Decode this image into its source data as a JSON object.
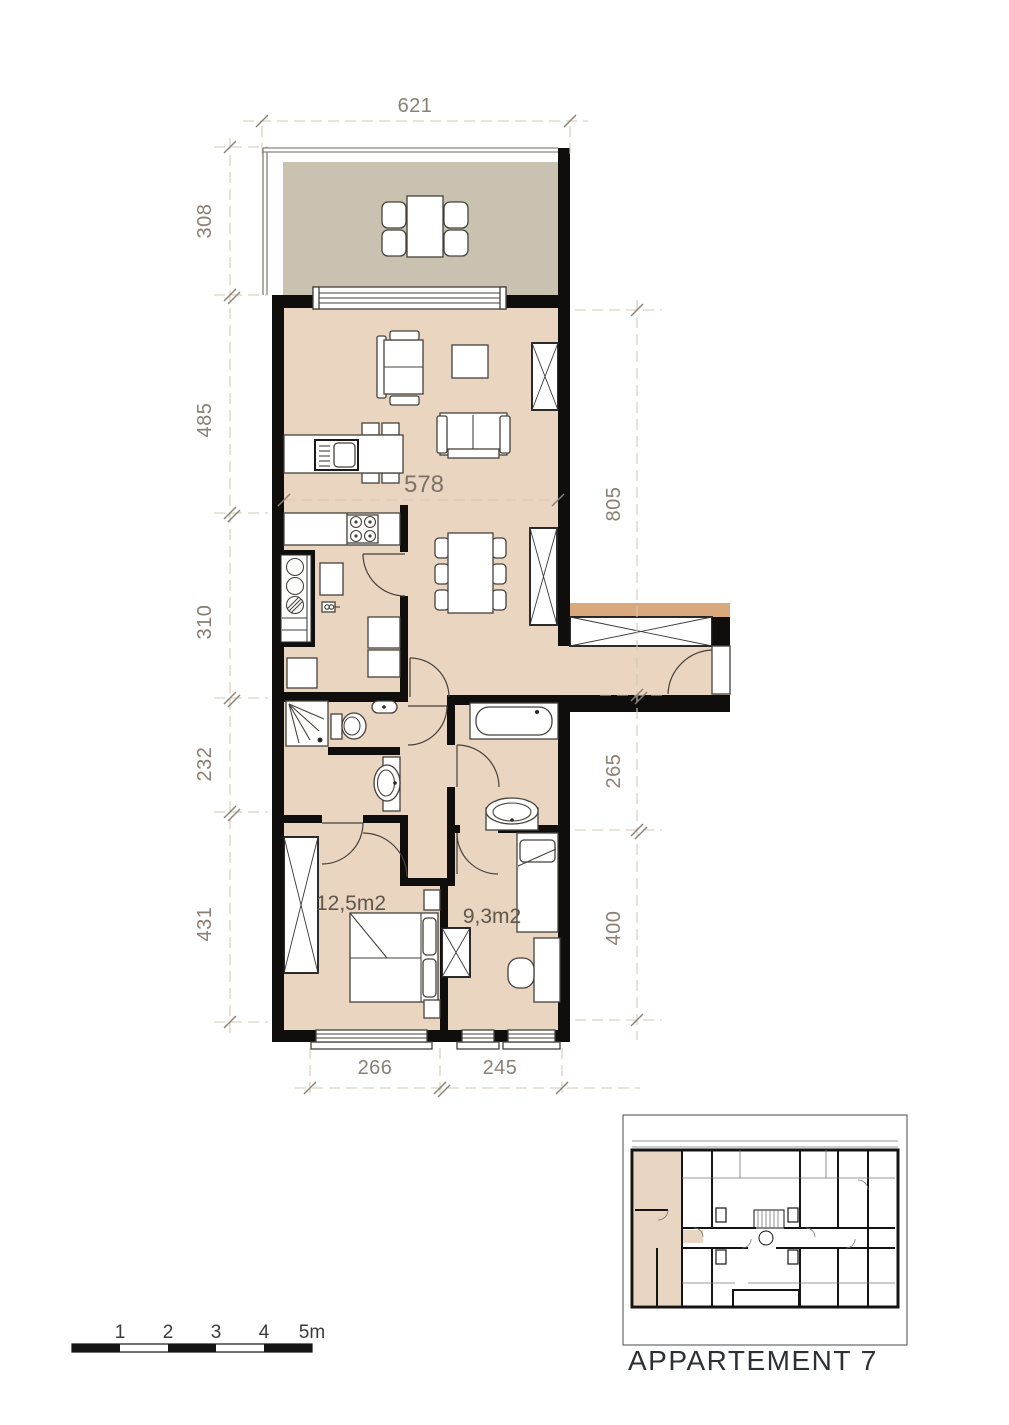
{
  "colors": {
    "wall": "#0f0e0c",
    "room": "#e9d5c0",
    "terrace": "#c9c2b1",
    "tan": "#d9a87c",
    "overview_room": "#e8d6c3",
    "dash": "#d2c8ba",
    "tick": "#8b8176",
    "dim_text": "#8a7f73",
    "ink": "#45413b"
  },
  "floor_plan": {
    "dimensions": {
      "top": "621",
      "left": [
        "308",
        "485",
        "310",
        "232",
        "431"
      ],
      "right": [
        "805",
        "265",
        "400"
      ],
      "bottom": [
        "266",
        "245"
      ],
      "interior_width": "578"
    },
    "rooms": {
      "bedroom_1": "12,5m2",
      "bedroom_2": "9,3m2"
    }
  },
  "scale_bar": {
    "labels": [
      "1",
      "2",
      "3",
      "4",
      "5m"
    ]
  },
  "overview": {
    "caption": "APPARTEMENT 7"
  }
}
